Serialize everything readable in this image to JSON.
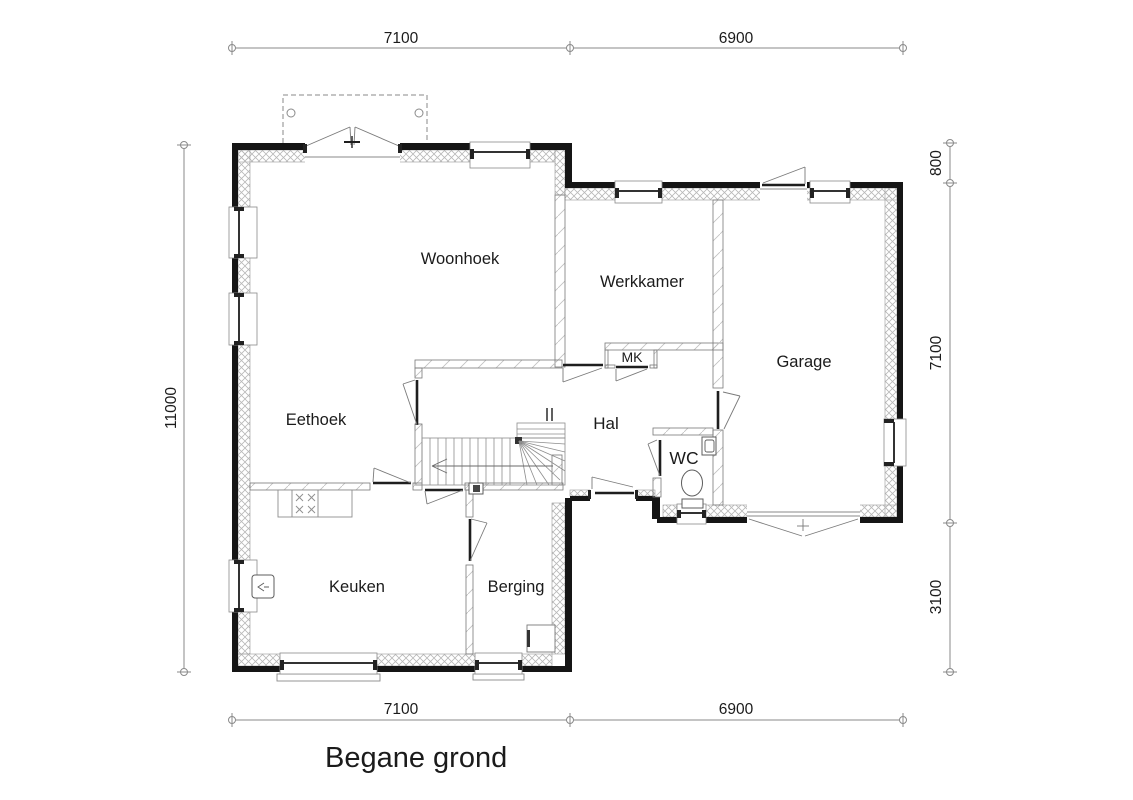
{
  "plan": {
    "title": "Begane grond",
    "rooms": {
      "woonhoek": "Woonhoek",
      "werkkamer": "Werkkamer",
      "garage": "Garage",
      "eethoek": "Eethoek",
      "hal": "Hal",
      "wc": "WC",
      "mk": "MK",
      "keuken": "Keuken",
      "berging": "Berging"
    },
    "dimensions": {
      "top": [
        "7100",
        "6900"
      ],
      "bottom": [
        "7100",
        "6900"
      ],
      "left": [
        "11000"
      ],
      "right": [
        "800",
        "7100",
        "3100"
      ]
    },
    "colors": {
      "wall": "#151515",
      "line": "#8a8a8a",
      "text": "#1b1b1b",
      "background": "#ffffff"
    }
  }
}
